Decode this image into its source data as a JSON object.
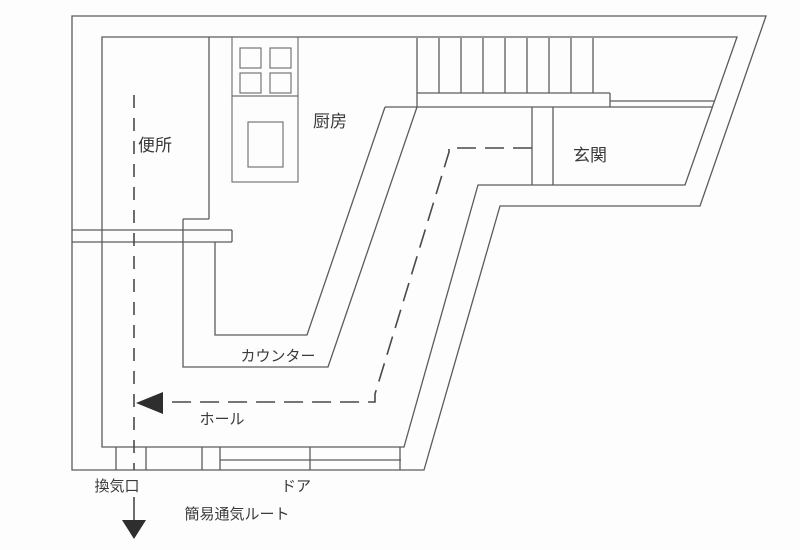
{
  "plan": {
    "rooms": {
      "toilet_label": "便所",
      "kitchen_label": "厨房",
      "entrance_label": "玄関",
      "hall_label": "ホール"
    },
    "features": {
      "counter_label": "カウンター",
      "vent_label": "換気口",
      "door_label": "ドア"
    },
    "route": {
      "caption": "簡易通気ルート"
    },
    "icons": {
      "flow_left_arrow": "left-arrow",
      "exit_down_arrow": "down-arrow"
    },
    "colors": {
      "wall_line": "#5b5b5b",
      "label_text": "#3a3a3a",
      "arrow_fill": "#2e2e2e",
      "background": "#fdfdfd"
    }
  }
}
